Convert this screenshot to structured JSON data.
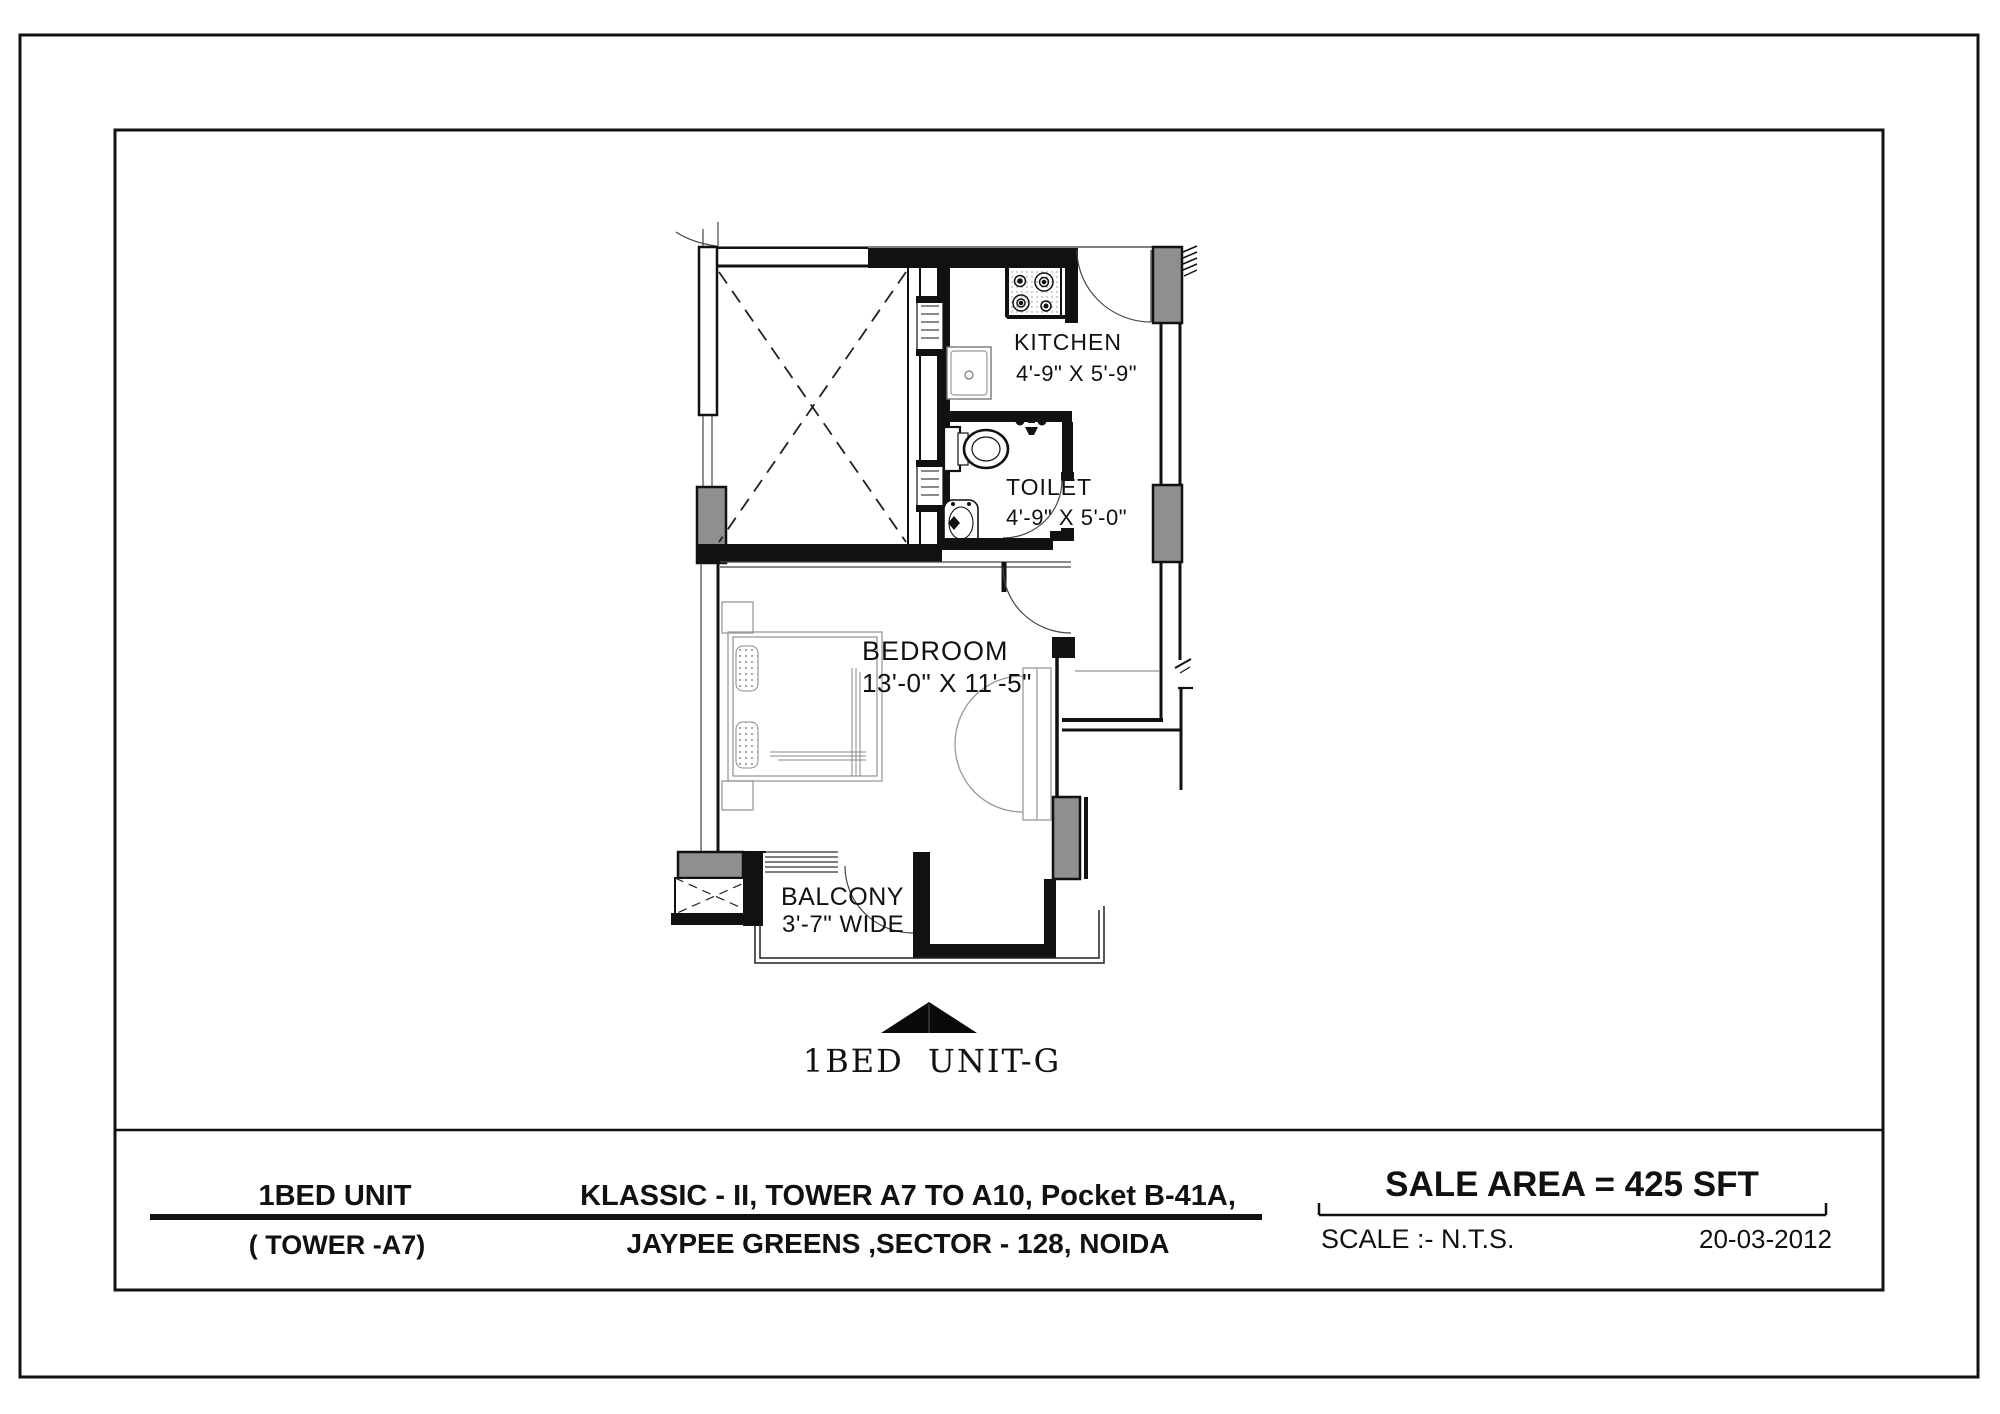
{
  "plan": {
    "rooms": {
      "kitchen": {
        "name": "KITCHEN",
        "dims": "4'-9\" X 5'-9\""
      },
      "toilet": {
        "name": "TOILET",
        "dims": "4'-9\" X 5'-0\""
      },
      "bedroom": {
        "name": "BEDROOM",
        "dims": "13'-0\" X 11'-5\""
      },
      "balcony": {
        "name": "BALCONY",
        "dims": "3'-7\" WIDE"
      }
    },
    "north_label": "1BED UNIT-G"
  },
  "title_block": {
    "unit_type": "1BED UNIT",
    "tower": "( TOWER -A7)",
    "project_line1": "KLASSIC - II, TOWER A7 TO A10,  Pocket B-41A,",
    "project_line2": "JAYPEE GREENS ,SECTOR - 128, NOIDA",
    "sale_area": "SALE AREA = 425 SFT",
    "scale_label": "SCALE :- N.T.S.",
    "date": "20-03-2012"
  },
  "colors": {
    "line": "#111111",
    "column_fill": "#8f8f8f",
    "furniture": "#9e9e9e"
  }
}
